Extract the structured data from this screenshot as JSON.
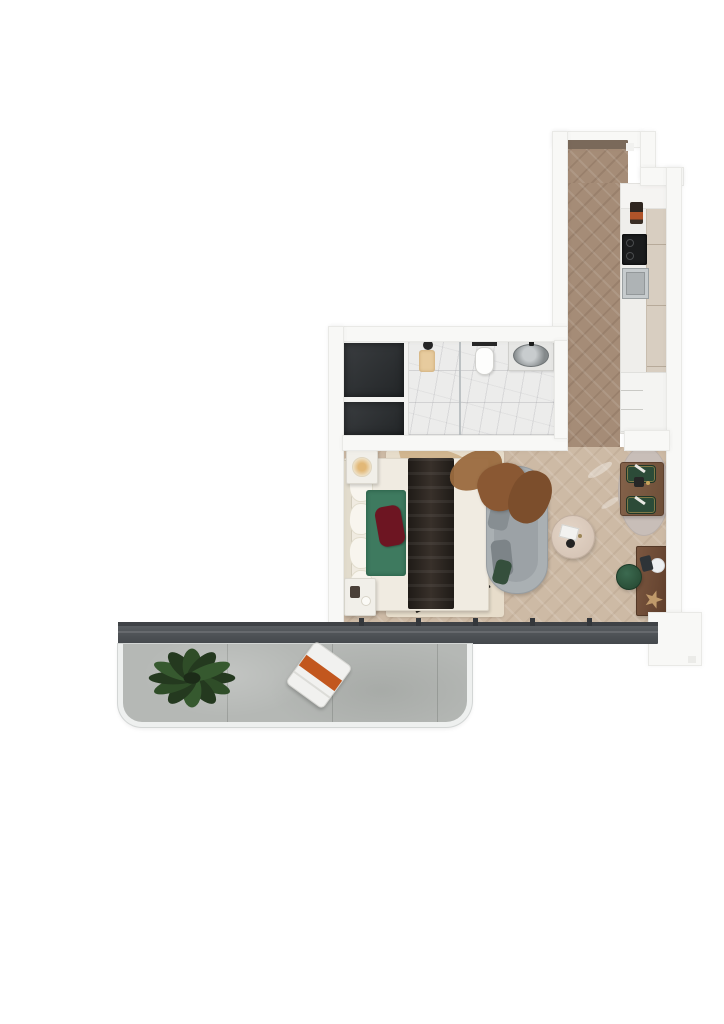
{
  "scene": {
    "title": "Studio apartment floor plan - 3D top-down render",
    "view": "top-down",
    "background": "#ffffff"
  },
  "rooms": [
    {
      "id": "entry-hall",
      "name": "Entry hallway",
      "floor": "dark herringbone wood",
      "items": [
        "entrance door threshold"
      ]
    },
    {
      "id": "kitchen",
      "name": "Kitchen run",
      "floor": "wood",
      "items": [
        "white upper cabinet",
        "orange small appliance",
        "black cooktop",
        "steel sink",
        "cream tall cabinets",
        "drawer / fridge unit"
      ]
    },
    {
      "id": "bathroom",
      "name": "Bathroom",
      "floor": "white marble tile",
      "items": [
        "walk-in shower",
        "glass partition",
        "black shower head",
        "beige bath mat",
        "wall-hung toilet",
        "black flush plate",
        "stone basin vanity with black faucet"
      ]
    },
    {
      "id": "wardrobe",
      "name": "Wardrobe closet",
      "floor": "white",
      "items": [
        "large dark wardrobe unit",
        "small dark wardrobe unit"
      ]
    },
    {
      "id": "bedroom",
      "name": "Bedroom and lounge",
      "floor": "light herringbone wood",
      "items": [
        "double bed with white bedding",
        "dark bed runner",
        "green throw",
        "burgundy cushion",
        "white pillows",
        "nightstand with glowing lamp",
        "nightstand with decor",
        "patterned area rug",
        "grey chaise lounge",
        "brown fur throw",
        "grey cushions",
        "green cushion",
        "round coffee table with book"
      ]
    },
    {
      "id": "dining",
      "name": "Dining and desk corner",
      "floor": "light herringbone wood",
      "items": [
        "dark wood dining table",
        "two green chairs with brass trim",
        "oval rug",
        "wall desk",
        "green pouf",
        "white plate",
        "starfish decor plant"
      ]
    },
    {
      "id": "balcony",
      "name": "Balcony",
      "floor": "concrete slabs",
      "items": [
        "leafy potted plant",
        "white lounge chair with orange cushion",
        "rounded glass railing"
      ]
    }
  ],
  "architecture": {
    "window_wall": "full-width dark sliding glass door track with mullions",
    "entrance": "door opening at top of hallway"
  },
  "palette": {
    "wall": "#f8f8f6",
    "wood_hall": "#a58c77",
    "wood_living": "#cdbaa5",
    "marble": "#ececeb",
    "wardrobe_dark": "#2e3134",
    "window_frame": "#4e5256",
    "balcony_concrete": "#b5b8b5",
    "plant_green": "#2e4a2b",
    "accent_orange": "#c2571e",
    "accent_green": "#3e7a5f",
    "accent_burgundy": "#6d1522",
    "sofa_grey": "#aab0b3",
    "dining_table_wood": "#7d5c42",
    "chair_green": "#2c4b38",
    "desk_wood": "#6f4e38"
  }
}
